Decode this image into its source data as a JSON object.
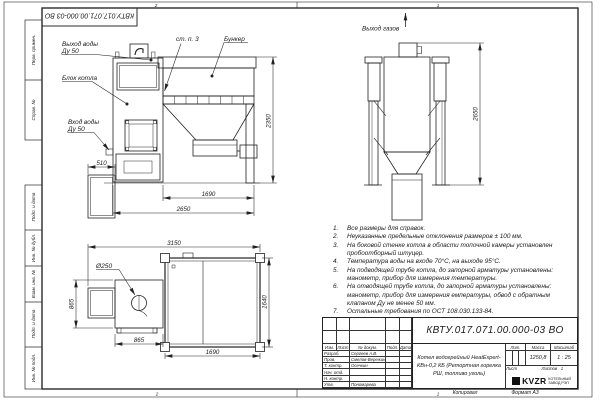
{
  "sheet": {
    "doc_number": "КВТУ.017.071.00.000-03 ВО",
    "zones": {
      "top_left": "2",
      "top_right": "1",
      "bottom_left": "2",
      "bottom_right": "1"
    },
    "footer": {
      "copied": "Копировал",
      "format": "Формат А3"
    },
    "margin_fields": {
      "perv_primen": "Перв. примен.",
      "sprav_no": "Справ. №",
      "podp_data_1": "Подп. и дата",
      "inv_dubl": "Инв. № дубл.",
      "vzam_inv": "Взам. инв. №",
      "podp_data_2": "Подп. и дата",
      "inv_podl": "Инв. № подл."
    }
  },
  "views": {
    "front": {
      "labels": {
        "water_out_line1": "Выход воды",
        "water_out_line2": "Ду 50",
        "boiler_block": "Блок котла",
        "water_in_line1": "Вход воды",
        "water_in_line2": "Ду 50",
        "wall_note": "ст. п. 3",
        "bunker": "Бункер"
      },
      "dims": {
        "cabinet": "510",
        "bunker": "1690",
        "total": "2650",
        "height": "2350"
      }
    },
    "side": {
      "labels": {
        "gas_out": "Выход газов"
      },
      "dims": {
        "height": "2650"
      }
    },
    "plan": {
      "labels": {
        "chimney_dia": "Ø250"
      },
      "dims": {
        "total": "3150",
        "boiler_depth": "865",
        "boiler_width": "865",
        "bunker_depth": "1640",
        "bunker_width": "1690"
      }
    }
  },
  "notes": {
    "items": [
      {
        "num": "1.",
        "text": "Все размеры для справок."
      },
      {
        "num": "2.",
        "text": "Неуказанные предельные отклонения размеров ± 100 мм."
      },
      {
        "num": "3.",
        "text": "На боковой стенке котла в области топочной камеры установлен пробоотборный штуцер."
      },
      {
        "num": "4.",
        "text": "Температура воды на входе 70°С, на выходе 95°С."
      },
      {
        "num": "5.",
        "text": "На подводящей трубе котла, до запорной арматуры установлены: манометр, прибор для измерения температуры."
      },
      {
        "num": "6.",
        "text": "На отводящей трубе котла, до запорной арматуры установлены: манометр, прибор для измерения емпературы, обвод с обратным клапаном Ду не менее 50 мм."
      },
      {
        "num": "7.",
        "text": "Остальные требования по ОСТ 108.030.133-84."
      }
    ]
  },
  "title_block": {
    "doc_number": "КВТУ.017.071.00.000-03 ВО",
    "product_name": "Котел водогрейный HeatExpert-КВн-0,2 КБ (Ретортная горелка РШ, топливо уголь)",
    "cols": {
      "izm": "Изм.",
      "list": "Лист",
      "dokum": "№ докум.",
      "podp": "Подп.",
      "data": "Дата"
    },
    "rows": [
      {
        "role": "Разраб.",
        "name": "Сергеев А.В."
      },
      {
        "role": "Пров.",
        "name": "Смелов-Вережинский"
      },
      {
        "role": "Т. контр.",
        "name": "Осечкин"
      },
      {
        "role": "Нач. отд.",
        "name": ""
      },
      {
        "role": "Н. контр.",
        "name": ""
      },
      {
        "role": "Утв.",
        "name": "Пономарева"
      }
    ],
    "lit_label": "Лит.",
    "mass_label": "Масса",
    "scale_label": "Масштаб",
    "mass_value": "1250,8",
    "scale_value": "1 : 25",
    "sheet_label": "Лист",
    "sheets_label": "Листов",
    "sheets_value": "1",
    "logo_text": "KVZR",
    "logo_line1": "КОТЕЛЬНЫЙ",
    "logo_line2": "ЗАВОД РЭП"
  }
}
